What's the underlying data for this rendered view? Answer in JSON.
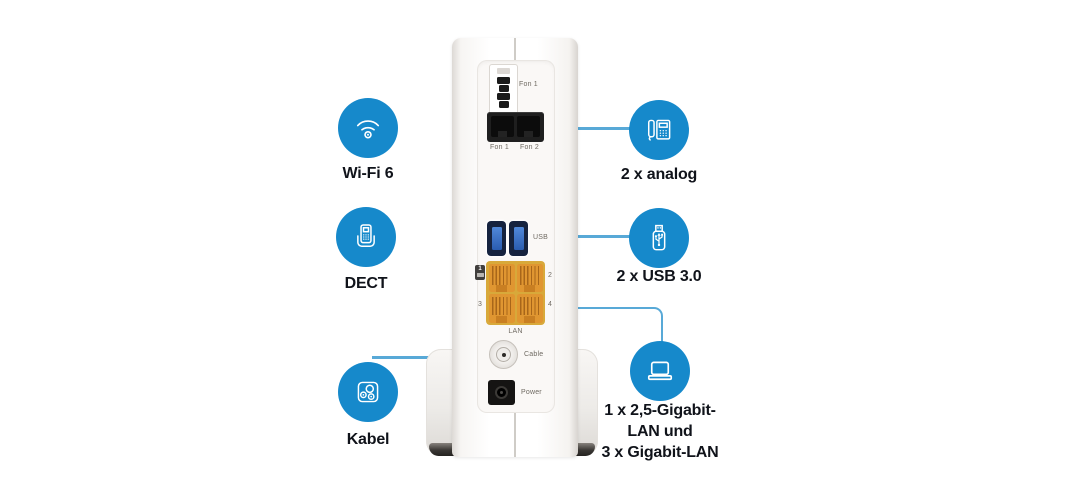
{
  "colors": {
    "accent_blue": "#1689cb",
    "line_blue": "#58a9d7",
    "label_dark": "#10131a",
    "lan_orange": "#e09631",
    "usb_blue": "#2a5cb0"
  },
  "callouts": {
    "left": [
      {
        "icon": "wifi-icon",
        "label": "Wi-Fi 6"
      },
      {
        "icon": "dect-phone-icon",
        "label": "DECT"
      },
      {
        "icon": "cable-socket-icon",
        "label": "Kabel"
      }
    ],
    "right": [
      {
        "icon": "analog-phone-icon",
        "label": "2 x analog"
      },
      {
        "icon": "usb-stick-icon",
        "label": "2 x USB 3.0"
      },
      {
        "icon": "laptop-icon",
        "label_lines": [
          "1 x 2,5-Gigabit-",
          "LAN und",
          "3 x Gigabit-LAN"
        ]
      }
    ]
  },
  "router": {
    "ports": {
      "tae": {
        "label": "Fon 1"
      },
      "rj11": {
        "labels": [
          "Fon 1",
          "Fon 2"
        ]
      },
      "usb": {
        "label": "USB"
      },
      "lan": {
        "label": "LAN",
        "port1_badge": "1",
        "port2": "2",
        "port3": "3",
        "port4": "4"
      },
      "cable": {
        "label": "Cable"
      },
      "power": {
        "label": "Power"
      }
    }
  }
}
